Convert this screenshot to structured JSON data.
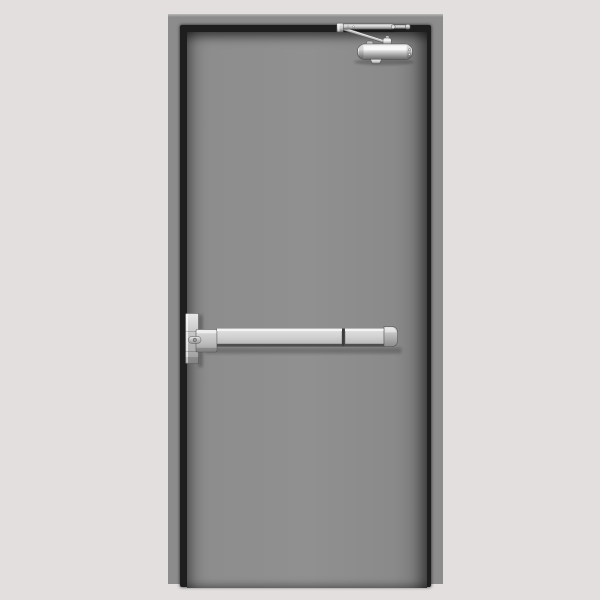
{
  "scene": {
    "subject": "Gray hollow-metal fire-rated door, front view, fitted with a panic exit push bar and an overhead surface-mounted door closer",
    "background": "plain light-gray studio backdrop",
    "visible_text": ""
  },
  "colors": {
    "bg": "#e2dfde",
    "frame": "#8c8c8c",
    "frame-edge": "#bab8b7",
    "reveal": "#1e1e1e",
    "door": "#8d8d8d",
    "door-edge": "#787878",
    "metal-hi": "#f3f3f3",
    "metal-mid": "#c9c9c9",
    "metal-lo": "#9a9a9a",
    "metal-dark": "#666666",
    "outline": "#525252"
  },
  "parts": {
    "frame": "hollow metal door frame",
    "leaf": "gray steel door leaf",
    "closer": "overhead door closer",
    "closer_arm": "closer arm assembly",
    "closer_body": "closer cylinder body",
    "exit_device": "panic exit device (crash bar)",
    "chassis": "exit device chassis and vertical rail plate",
    "dogging": "dogging cylinder",
    "push_bar": "horizontal push bar",
    "end_cap": "push bar end cap"
  }
}
